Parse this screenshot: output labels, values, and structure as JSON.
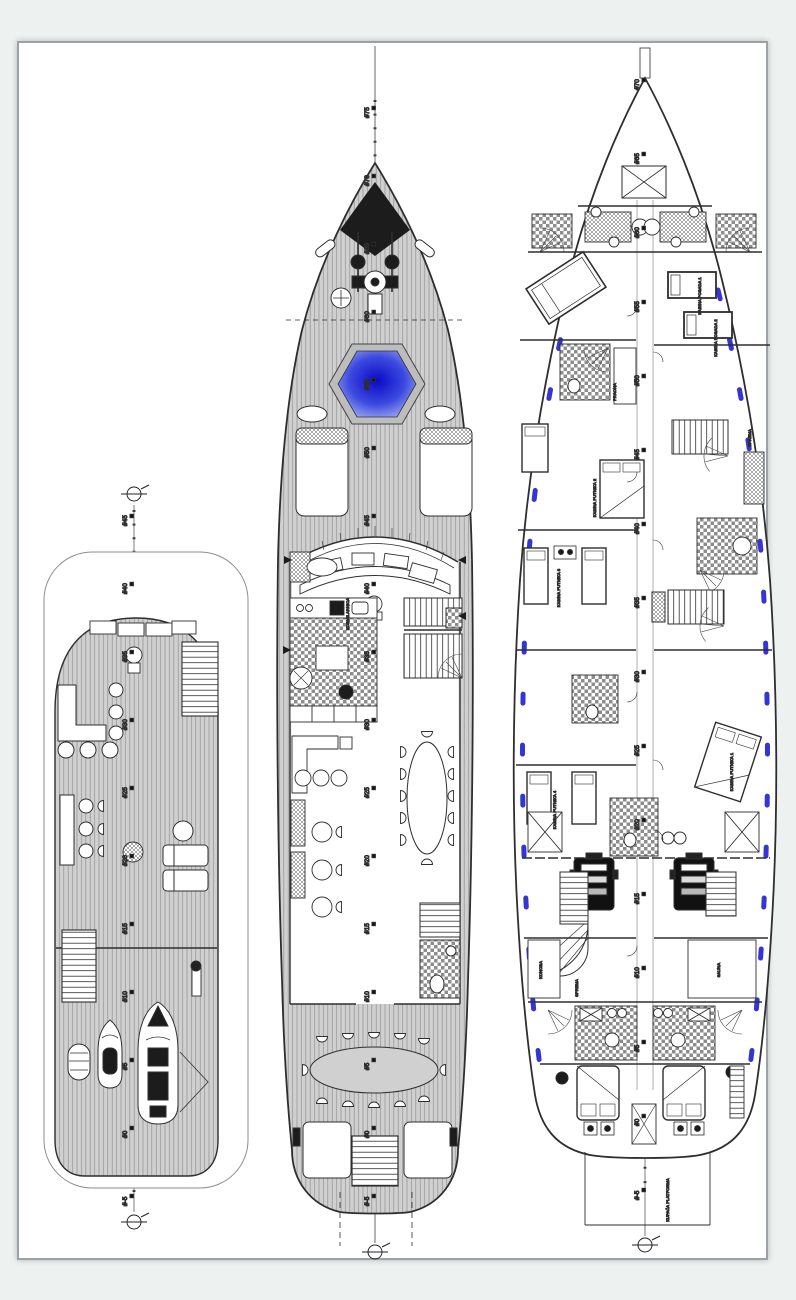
{
  "page": {
    "background": "#edf2f0",
    "sheet_bg": "#ffffff",
    "sheet_border": "#9ba1a6"
  },
  "colors": {
    "line": "#2e2e2e",
    "plank_fill": "#d0d0d0",
    "plank_line": "#8f8f8f",
    "tile_gray": "#8d8d8d",
    "porthole_blue": "#2a2ad0",
    "jacuzzi_blue": "#1313cc",
    "bow_plate_black": "#1c1c1c"
  },
  "decks": {
    "sun": {
      "frames": [
        {
          "label": "#45",
          "y": 516
        },
        {
          "label": "#40",
          "y": 584
        },
        {
          "label": "#35",
          "y": 652
        },
        {
          "label": "#30",
          "y": 720
        },
        {
          "label": "#25",
          "y": 788
        },
        {
          "label": "#20",
          "y": 856
        },
        {
          "label": "#15",
          "y": 924
        },
        {
          "label": "#10",
          "y": 992
        },
        {
          "label": "#5",
          "y": 1060
        },
        {
          "label": "#0",
          "y": 1128
        },
        {
          "label": "#-5",
          "y": 1196
        }
      ],
      "labels": []
    },
    "main": {
      "frames": [
        {
          "label": "#75",
          "y": 108
        },
        {
          "label": "#70",
          "y": 176
        },
        {
          "label": "#65",
          "y": 244
        },
        {
          "label": "#60",
          "y": 312
        },
        {
          "label": "#55",
          "y": 380
        },
        {
          "label": "#50",
          "y": 448
        },
        {
          "label": "#45",
          "y": 516
        },
        {
          "label": "#40",
          "y": 584
        },
        {
          "label": "#35",
          "y": 652
        },
        {
          "label": "#30",
          "y": 720
        },
        {
          "label": "#25",
          "y": 788
        },
        {
          "label": "#20",
          "y": 856
        },
        {
          "label": "#15",
          "y": 924
        },
        {
          "label": "#10",
          "y": 992
        },
        {
          "label": "#5",
          "y": 1060
        },
        {
          "label": "#0",
          "y": 1128
        },
        {
          "label": "#-5",
          "y": 1196
        }
      ],
      "labels": [
        {
          "text": "KORMILARNICA",
          "x": 349,
          "y": 614
        }
      ]
    },
    "lower": {
      "frames": [
        {
          "label": "#70",
          "y": 80
        },
        {
          "label": "#65",
          "y": 154
        },
        {
          "label": "#60",
          "y": 228
        },
        {
          "label": "#55",
          "y": 302
        },
        {
          "label": "#50",
          "y": 376
        },
        {
          "label": "#45",
          "y": 450
        },
        {
          "label": "#40",
          "y": 524
        },
        {
          "label": "#35",
          "y": 598
        },
        {
          "label": "#30",
          "y": 672
        },
        {
          "label": "#25",
          "y": 746
        },
        {
          "label": "#20",
          "y": 820
        },
        {
          "label": "#15",
          "y": 894
        },
        {
          "label": "#10",
          "y": 968
        },
        {
          "label": "#5",
          "y": 1042
        },
        {
          "label": "#0",
          "y": 1116
        },
        {
          "label": "#-5",
          "y": 1190
        }
      ],
      "labels": [
        {
          "text": "KABINA POSADA 1",
          "x": 701,
          "y": 296
        },
        {
          "text": "KABINA POSADA 2",
          "x": 717,
          "y": 338
        },
        {
          "text": "PRAONA",
          "x": 616,
          "y": 392
        },
        {
          "text": "SPREMA",
          "x": 751,
          "y": 438
        },
        {
          "text": "KABINA PUTNIKA 2",
          "x": 596,
          "y": 498
        },
        {
          "text": "KABINA PUTNIKA 3",
          "x": 560,
          "y": 588
        },
        {
          "text": "KABINA PUTNIKA 1",
          "x": 733,
          "y": 772
        },
        {
          "text": "KABINA PUTNIKA 4",
          "x": 556,
          "y": 810
        },
        {
          "text": "KONOBA",
          "x": 542,
          "y": 970
        },
        {
          "text": "SPREMA",
          "x": 578,
          "y": 988
        },
        {
          "text": "SAUNA",
          "x": 720,
          "y": 970
        },
        {
          "text": "KUPAĆA PLATFORMA",
          "x": 669,
          "y": 1200
        }
      ]
    }
  }
}
